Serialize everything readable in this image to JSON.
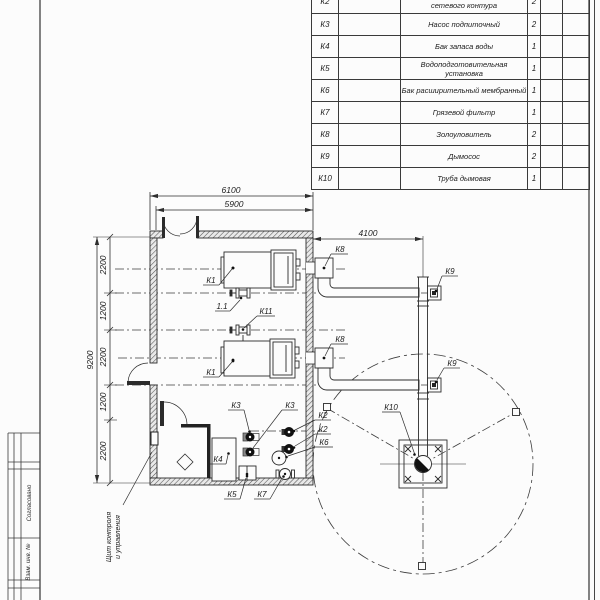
{
  "spec_table": {
    "rows": [
      {
        "pos": "К2",
        "name": "сетевого контура",
        "qty": "2"
      },
      {
        "pos": "К3",
        "name": "Насос подпиточный",
        "qty": "2"
      },
      {
        "pos": "К4",
        "name": "Бак запаса воды",
        "qty": "1"
      },
      {
        "pos": "К5",
        "name": "Водоподготовительная установка",
        "qty": "1"
      },
      {
        "pos": "К6",
        "name": "Бак расширительный мембранный",
        "qty": "1"
      },
      {
        "pos": "К7",
        "name": "Грязевой фильтр",
        "qty": "1"
      },
      {
        "pos": "К8",
        "name": "Золоуловитель",
        "qty": "2"
      },
      {
        "pos": "К9",
        "name": "Дымосос",
        "qty": "2"
      },
      {
        "pos": "К10",
        "name": "Труба дымовая",
        "qty": "1"
      }
    ]
  },
  "dimensions": {
    "top_overall": "6100",
    "top_inner": "5900",
    "right_offset": "4100",
    "left_overall": "9200",
    "chain": [
      "2200",
      "1200",
      "2200",
      "1200",
      "2200"
    ]
  },
  "equipment_labels": {
    "boiler": "К1",
    "pipeline": "1.1",
    "valve": "К11",
    "network_pump": "К2",
    "feed_pump": "К3",
    "water_tank": "К4",
    "water_treatment": "К5",
    "expansion_tank": "К6",
    "mud_filter": "К7",
    "ash_collector": "К8",
    "smoke_exhauster": "К9",
    "chimney": "К10"
  },
  "annotations": {
    "control_panel_line1": "Щит контроля",
    "control_panel_line2": "и управления"
  },
  "title_block": {
    "approved": "Согласовано",
    "replacement_inv": "Взам. инв. №"
  }
}
